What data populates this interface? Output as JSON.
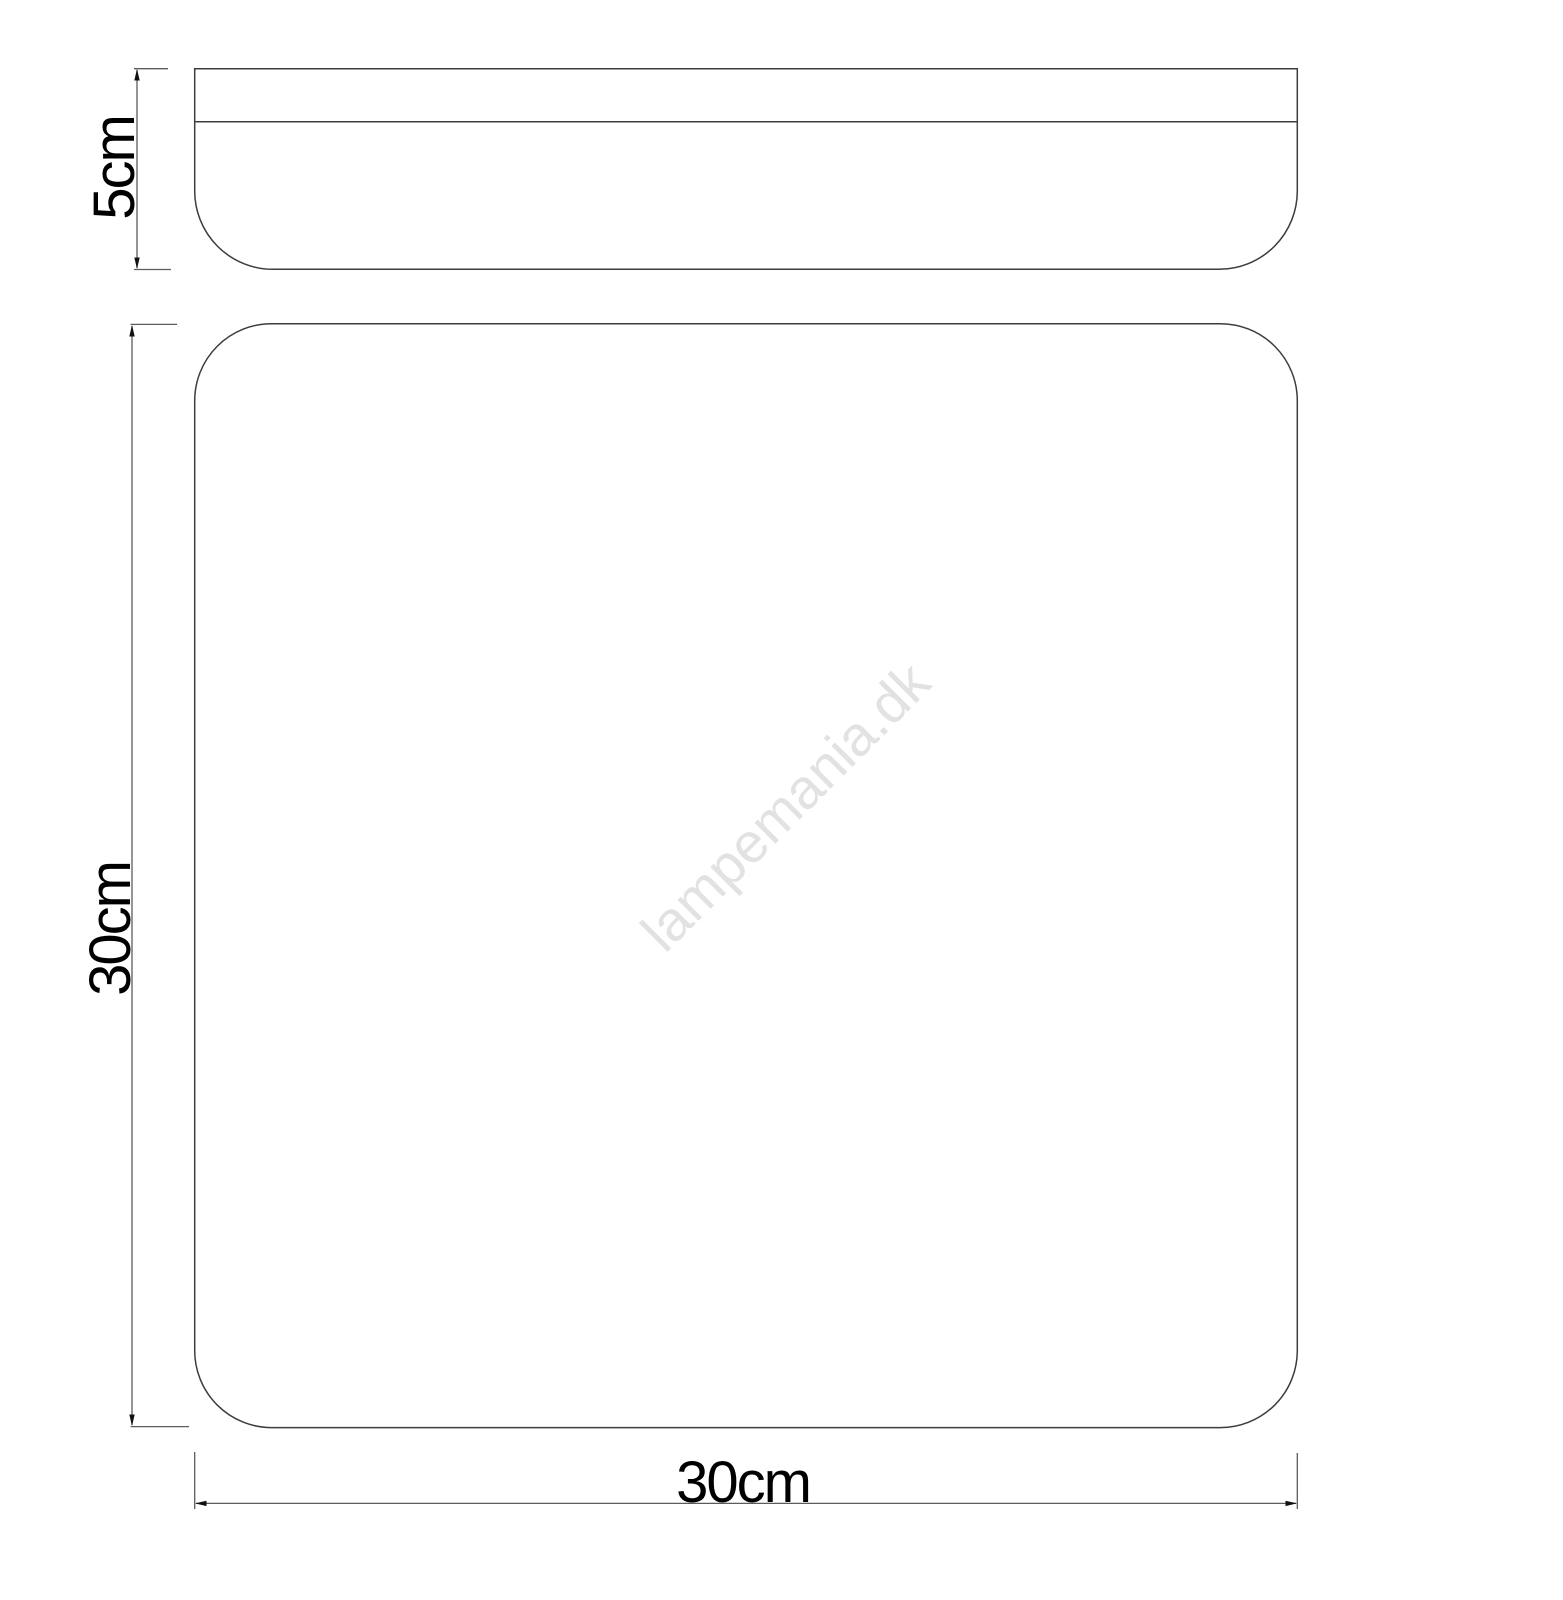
{
  "diagram": {
    "watermark": "lampemania.dk",
    "dimensions": {
      "height_label": "5cm",
      "depth_label": "30cm",
      "width_label": "30cm"
    },
    "colors": {
      "outline": "#3d3d3d",
      "dimension_line": "#5c5c5c",
      "arrow": "#111111",
      "label_text": "#000000",
      "watermark": "#e2e2e2",
      "background": "#ffffff"
    }
  }
}
